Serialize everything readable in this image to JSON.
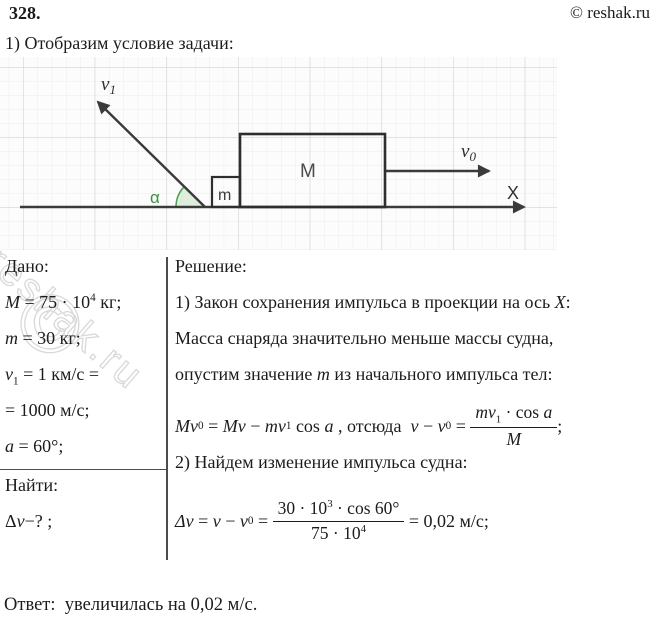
{
  "header": {
    "problem_number": "328.",
    "copyright": "© reshak.ru"
  },
  "intro": "1) Отобразим условие задачи:",
  "diagram": {
    "v1_label": {
      "base": "v",
      "sub": "1"
    },
    "v0_label": {
      "base": "v",
      "sub": "0"
    },
    "alpha_label": "α",
    "small_mass_label": "m",
    "large_mass_label": "M",
    "axis_label": "X",
    "colors": {
      "line": "#3a3a3a",
      "angle_fill": "#ddefdb",
      "angle_stroke": "#4aa251",
      "alpha_text": "#3c9144",
      "grid_minor": "#ededed",
      "grid_major": "#d3d3d3",
      "mass_label": "#4a4a4a"
    }
  },
  "given": {
    "title": "Дано:",
    "lines": [
      {
        "v": "M",
        "r": " = 75 · 10",
        "sup": "4",
        "r2": " кг;"
      },
      {
        "v": "m",
        "r": " = 30 кг;"
      },
      {
        "v": "v",
        "s": "1",
        "r": " = 1 км/с ="
      },
      {
        "r": "= 1000 м/с;"
      },
      {
        "v": "a",
        "r": " = 60°;"
      }
    ],
    "find_title": "Найти:",
    "find": {
      "pre": "Δ",
      "v": "v",
      "r": "−? ;"
    }
  },
  "solution": {
    "title": "Решение:",
    "step1": {
      "a": "1) Закон сохранения импульса в проекции на ось ",
      "b": "X",
      "c": ":"
    },
    "note1": "Масса снаряда значительно меньше массы судна,",
    "note2": {
      "a": "опустим значение ",
      "b": "m",
      "c": " из начального импульса тел:"
    },
    "formula1": {
      "t1": "Mv",
      "t1s": "0",
      "t2": " = ",
      "t3": "Mv",
      "t4": " − ",
      "t5": "mv",
      "t5s": "1",
      "t6": " cos ",
      "t7": "a",
      "t8": " , отсюда  ",
      "t9": "v",
      "t10": " − ",
      "t11": "v",
      "t11s": "0",
      "t12": " = ",
      "num": {
        "a": "mv",
        "as": "1",
        "b": " · cos ",
        "c": "a"
      },
      "den": "M",
      "end": ";"
    },
    "step2": "2) Найдем изменение импульса судна:",
    "formula2": {
      "t1": "Δv",
      "t2": " = ",
      "t3": "v",
      "t4": " − ",
      "t5": "v",
      "t5s": "0",
      "t6": " = ",
      "num": {
        "a": "30 · 10",
        "sup": "3",
        "b": " · cos 60°"
      },
      "den": {
        "a": "75 · 10",
        "sup": "4"
      },
      "end": " = 0,02 м/с;"
    }
  },
  "answer": "Ответ:  увеличилась на 0,02 м/с.",
  "watermark": {
    "text": "reshak.ru",
    "copyright_glyph": "©"
  }
}
